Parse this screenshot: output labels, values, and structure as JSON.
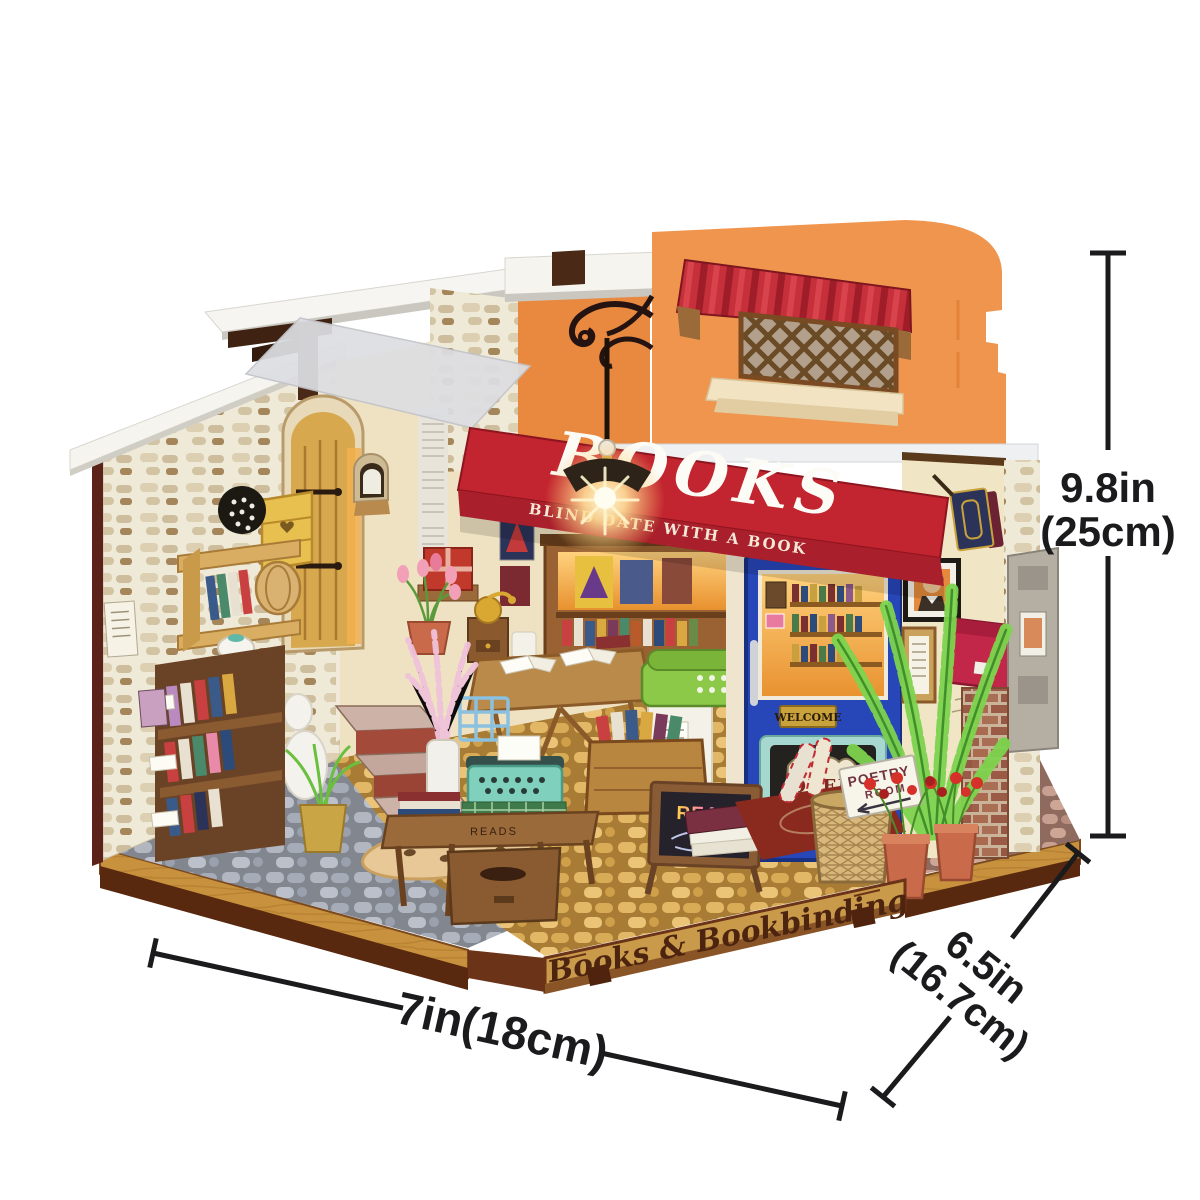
{
  "product": {
    "signs": {
      "awning_title": "BOOKS",
      "awning_subtitle": "BLIND DATE WITH A BOOK",
      "base_plaque": "Books & Bookbinding",
      "welcome": "WELCOME",
      "open": "OPEN",
      "poetry_line1": "POETRY",
      "poetry_line2": "ROOM",
      "chalkboard": "READ",
      "table_engraving": "READS"
    },
    "colors": {
      "background": "#ffffff",
      "awning_red": "#c2252f",
      "facade_orange": "#f0954e",
      "door_blue": "#2746b8",
      "base_wood": "#c8913e",
      "trim_brown": "#4f230d",
      "fern_green": "#7ed44e",
      "lamp_glow": "#ffe9ad",
      "dimension_text": "#1b1b1d"
    }
  },
  "annotations": {
    "height": {
      "imperial": "9.8in",
      "metric": "(25cm)"
    },
    "width": {
      "label": "7in(18cm)"
    },
    "depth": {
      "imperial": "6.5in",
      "metric": "(16.7cm)"
    }
  }
}
